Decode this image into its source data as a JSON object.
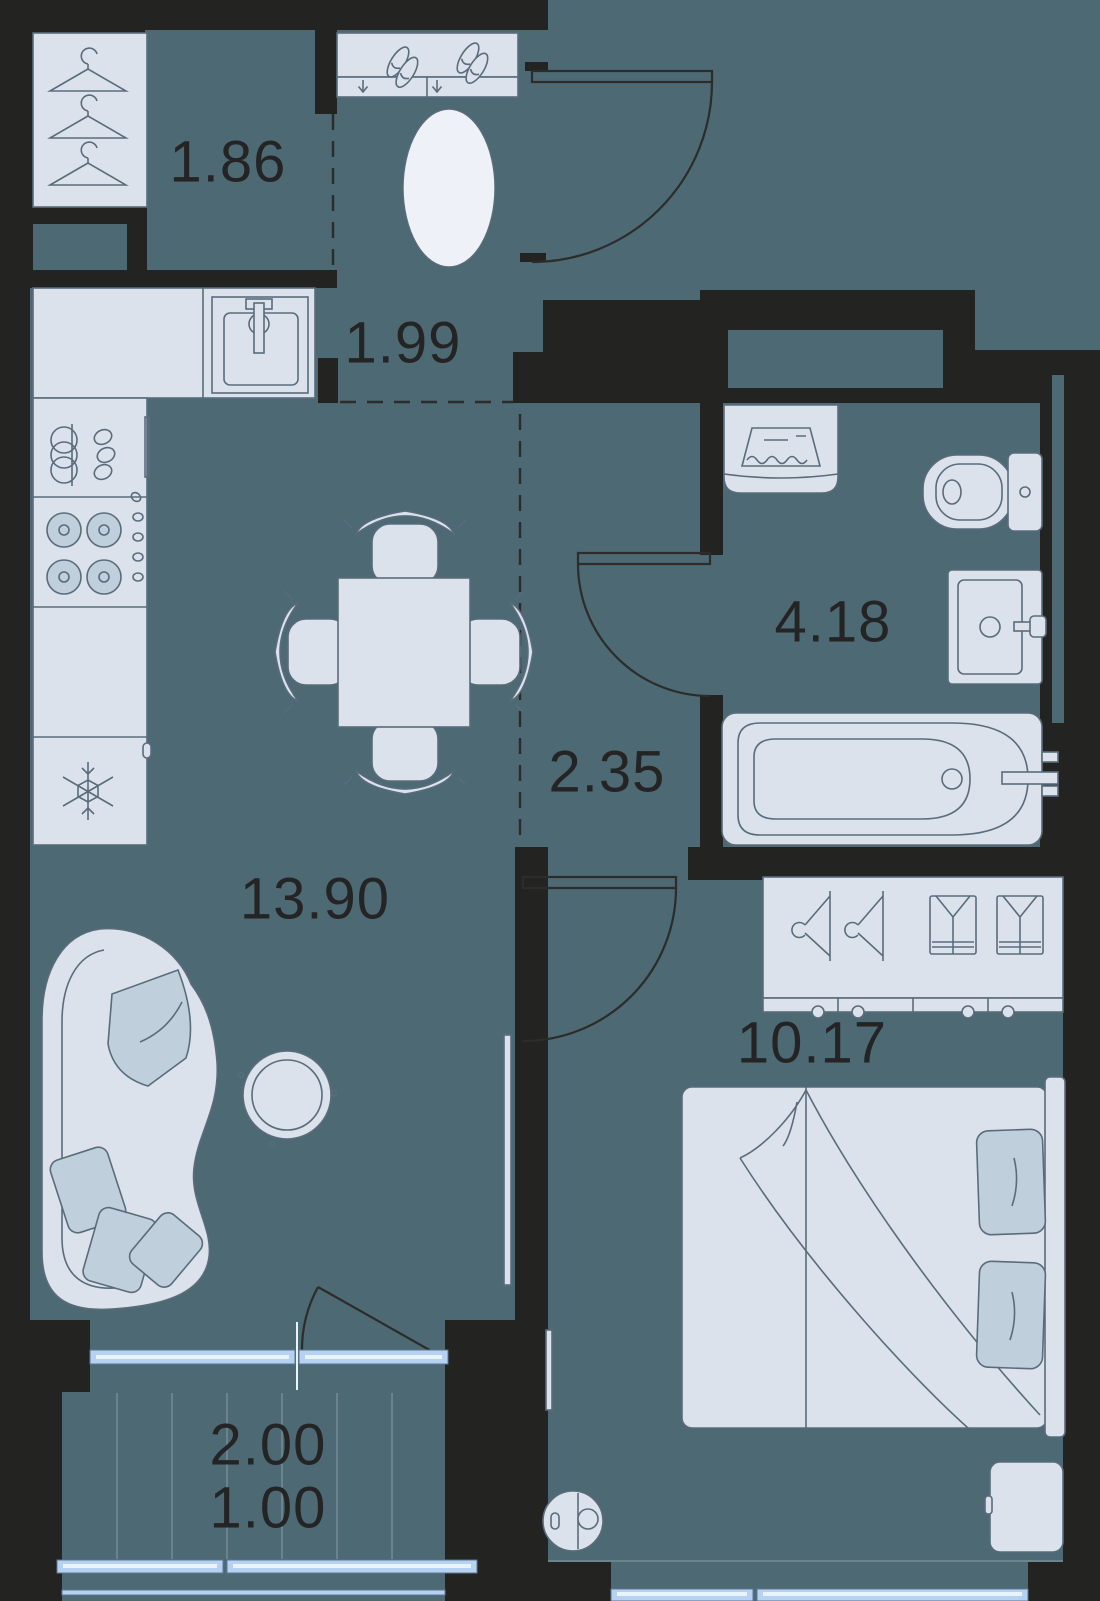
{
  "plan": {
    "rooms": [
      {
        "id": "wardrobe",
        "area": "1.86"
      },
      {
        "id": "hallway",
        "area": "1.99"
      },
      {
        "id": "bathroom",
        "area": "4.18"
      },
      {
        "id": "corridor",
        "area": "2.35"
      },
      {
        "id": "kitchen-living",
        "area": "13.90"
      },
      {
        "id": "bedroom",
        "area": "10.17"
      },
      {
        "id": "balcony-total",
        "area": "2.00"
      },
      {
        "id": "balcony-counted",
        "area": "1.00"
      }
    ],
    "colors": {
      "wall": "#232321",
      "floor": "#4d6973",
      "furniture": "#dbe2ec",
      "furniture_mid": "#bfd0dc",
      "outline": "#5a6c7c",
      "door_line": "#2c2c2a",
      "rug": "#eef2f8",
      "glass": "#b5d2f2",
      "glass_edge": "#5f7890",
      "glass_inner": "#eaf3fc",
      "plank": "#7f949e",
      "label": "#242424"
    }
  }
}
